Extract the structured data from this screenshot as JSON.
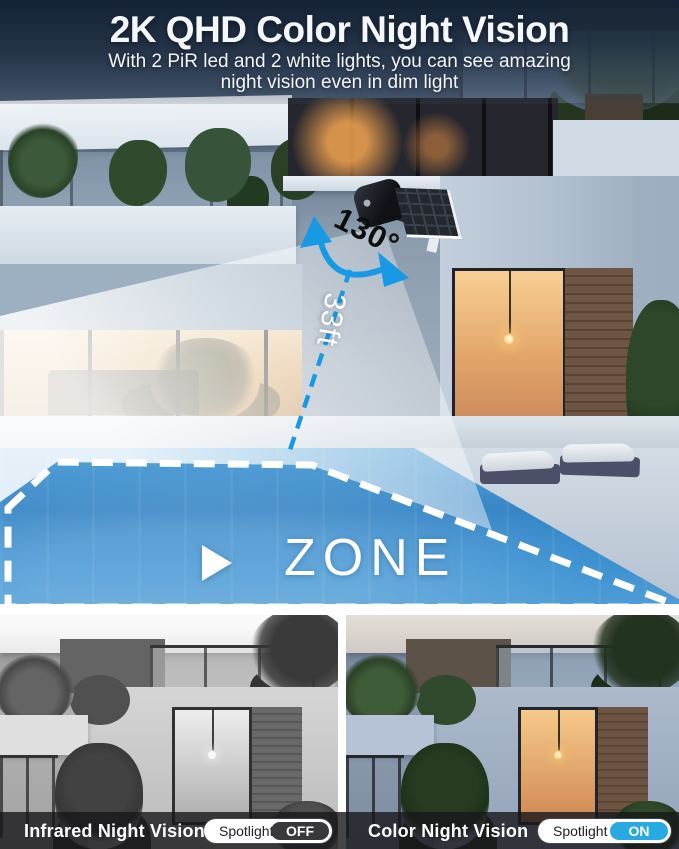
{
  "header": {
    "title": "2K QHD Color Night Vision",
    "subtitle_line1": "With 2 PiR led and 2 white lights, you can see amazing",
    "subtitle_line2": "night vision even in dim light"
  },
  "diagram": {
    "rotation_angle_label": "130°",
    "distance_label": "33ft",
    "zone_label": "ZONE",
    "accent_blue": "#179ae3",
    "zone_outline_color": "#ffffff",
    "beam_color": "#ffffff"
  },
  "comparison": {
    "left": {
      "label": "Infrared Night Vision",
      "toggle_label": "Spotlight",
      "toggle_state": "OFF",
      "toggle_state_color": "#39393b",
      "image_style": "grayscale"
    },
    "right": {
      "label": "Color Night Vision",
      "toggle_label": "Spotlight",
      "toggle_state": "ON",
      "toggle_state_color": "#27a9e1",
      "image_style": "color"
    }
  }
}
